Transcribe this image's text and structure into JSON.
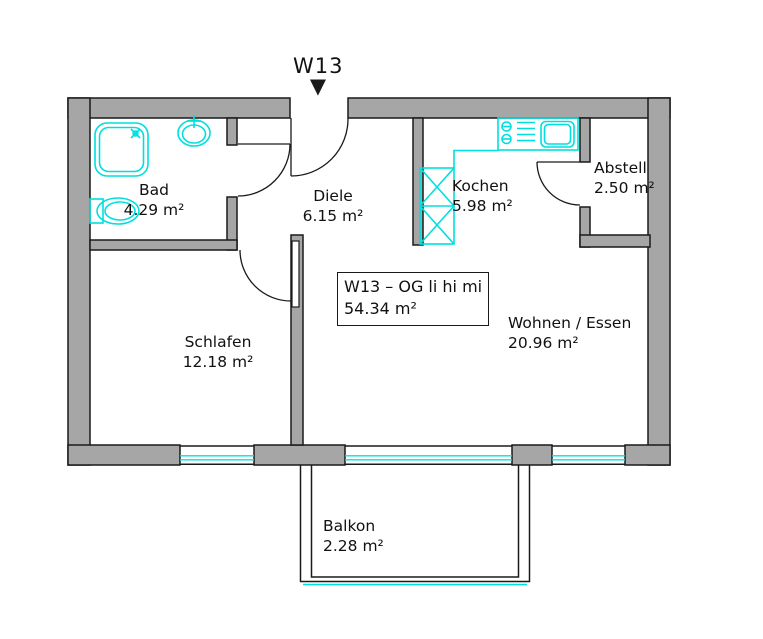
{
  "colors": {
    "background": "#ffffff",
    "wall_fill": "#a6a6a6",
    "line": "#1a1a1a",
    "fixture": "#00dfdf",
    "text": "#111111"
  },
  "entrance": {
    "label": "W13"
  },
  "icons": {
    "entrance_arrow": "▼"
  },
  "info_box": {
    "line1": "W13 – OG li hi mi",
    "line2": "54.34 m²"
  },
  "rooms": [
    {
      "name": "Bad",
      "area": "4.29 m²"
    },
    {
      "name": "Diele",
      "area": "6.15 m²"
    },
    {
      "name": "Kochen",
      "area": "5.98 m²"
    },
    {
      "name": "Abstell",
      "area": "2.50 m²"
    },
    {
      "name": "Schlafen",
      "area": "12.18 m²"
    },
    {
      "name": "Wohnen / Essen",
      "area": "20.96 m²"
    },
    {
      "name": "Balkon",
      "area": "2.28 m²"
    }
  ]
}
